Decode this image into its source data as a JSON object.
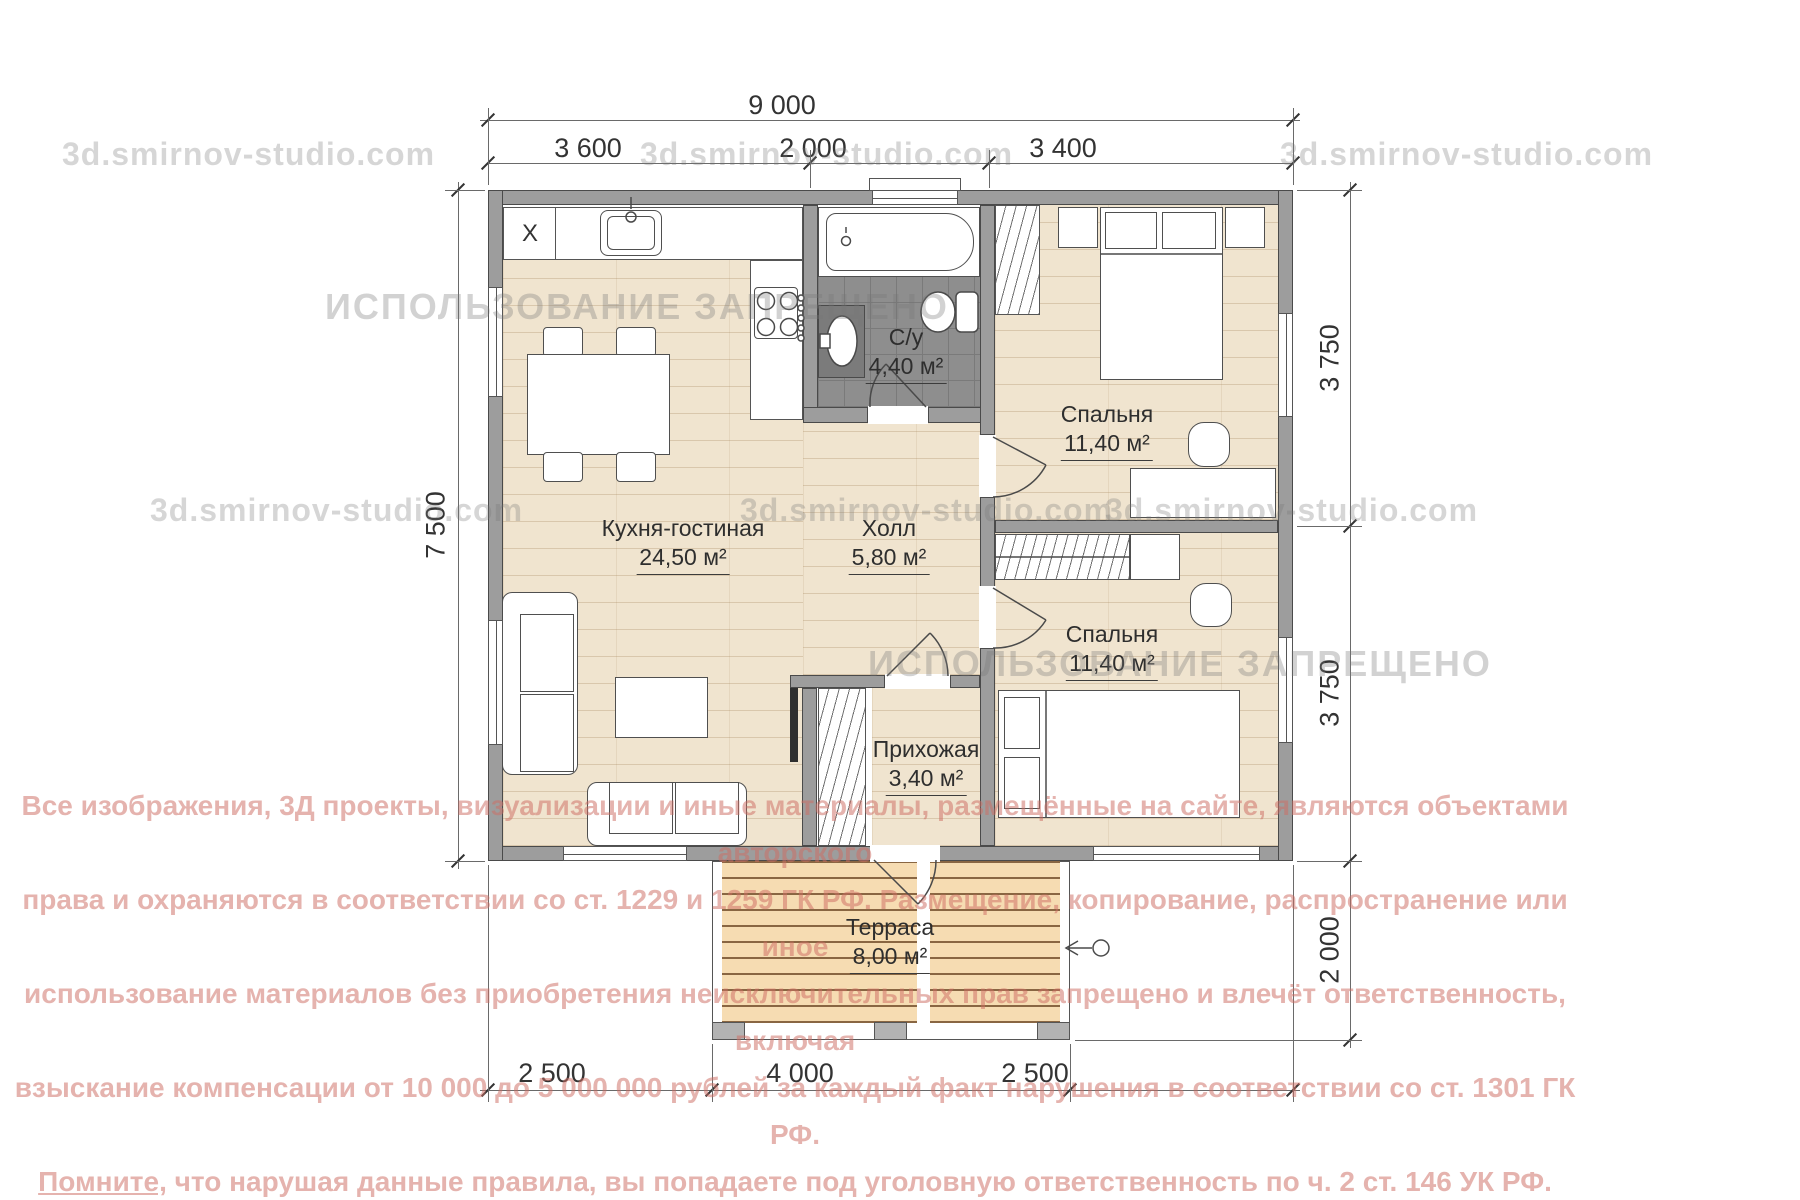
{
  "plan": {
    "rooms": {
      "kitchen_living": {
        "name": "Кухня-гостиная",
        "area": "24,50 м²"
      },
      "hall": {
        "name": "Холл",
        "area": "5,80 м²"
      },
      "bathroom": {
        "name": "С/у",
        "area": "4,40 м²"
      },
      "bedroom1": {
        "name": "Спальня",
        "area": "11,40 м²"
      },
      "bedroom2": {
        "name": "Спальня",
        "area": "11,40 м²"
      },
      "entry": {
        "name": "Прихожая",
        "area": "3,40 м²"
      },
      "terrace": {
        "name": "Терраса",
        "area": "8,00 м²"
      }
    },
    "fridge_mark": "X",
    "dimensions": {
      "top_total": "9 000",
      "top_segments": [
        "3 600",
        "2 000",
        "3 400"
      ],
      "left_total": "7 500",
      "right_segments": [
        "3 750",
        "3 750",
        "2 000"
      ],
      "bottom_segments": [
        "2 500",
        "4 000",
        "2 500"
      ]
    }
  },
  "watermarks": {
    "site": "3d.smirnov-studio.com",
    "forbidden": "ИСПОЛЬЗОВАНИЕ ЗАПРЕЩЕНО"
  },
  "copyright": {
    "line1": "Все изображения, 3Д проекты, визуализации и иные материалы, размещённые на сайте, являются объектами авторского",
    "line2": "права и охраняются в соответствии со ст. 1229 и 1259 ГК РФ. Размещение, копирование, распространение или иное",
    "line3": "использование материалов без приобретения неисключительных прав запрещено и влечёт ответственность, включая",
    "line4": "взыскание компенсации от 10 000 до 5 000 000 рублей за каждый факт нарушения в соответствии со ст. 1301 ГК РФ.",
    "line5_prefix": "Помните,",
    "line5_rest": " что нарушая данные правила, вы попадаете под уголовную ответственность по ч. 2 ст. 146 УК РФ."
  },
  "colors": {
    "wall": "#9d9d9d",
    "wood_floor": "#f0e4cf",
    "terrace_deck": "#f6dcb2",
    "bath_tile": "#8e8e8e",
    "copyright_red": "#cd6e64",
    "watermark_gray": "#787878"
  }
}
